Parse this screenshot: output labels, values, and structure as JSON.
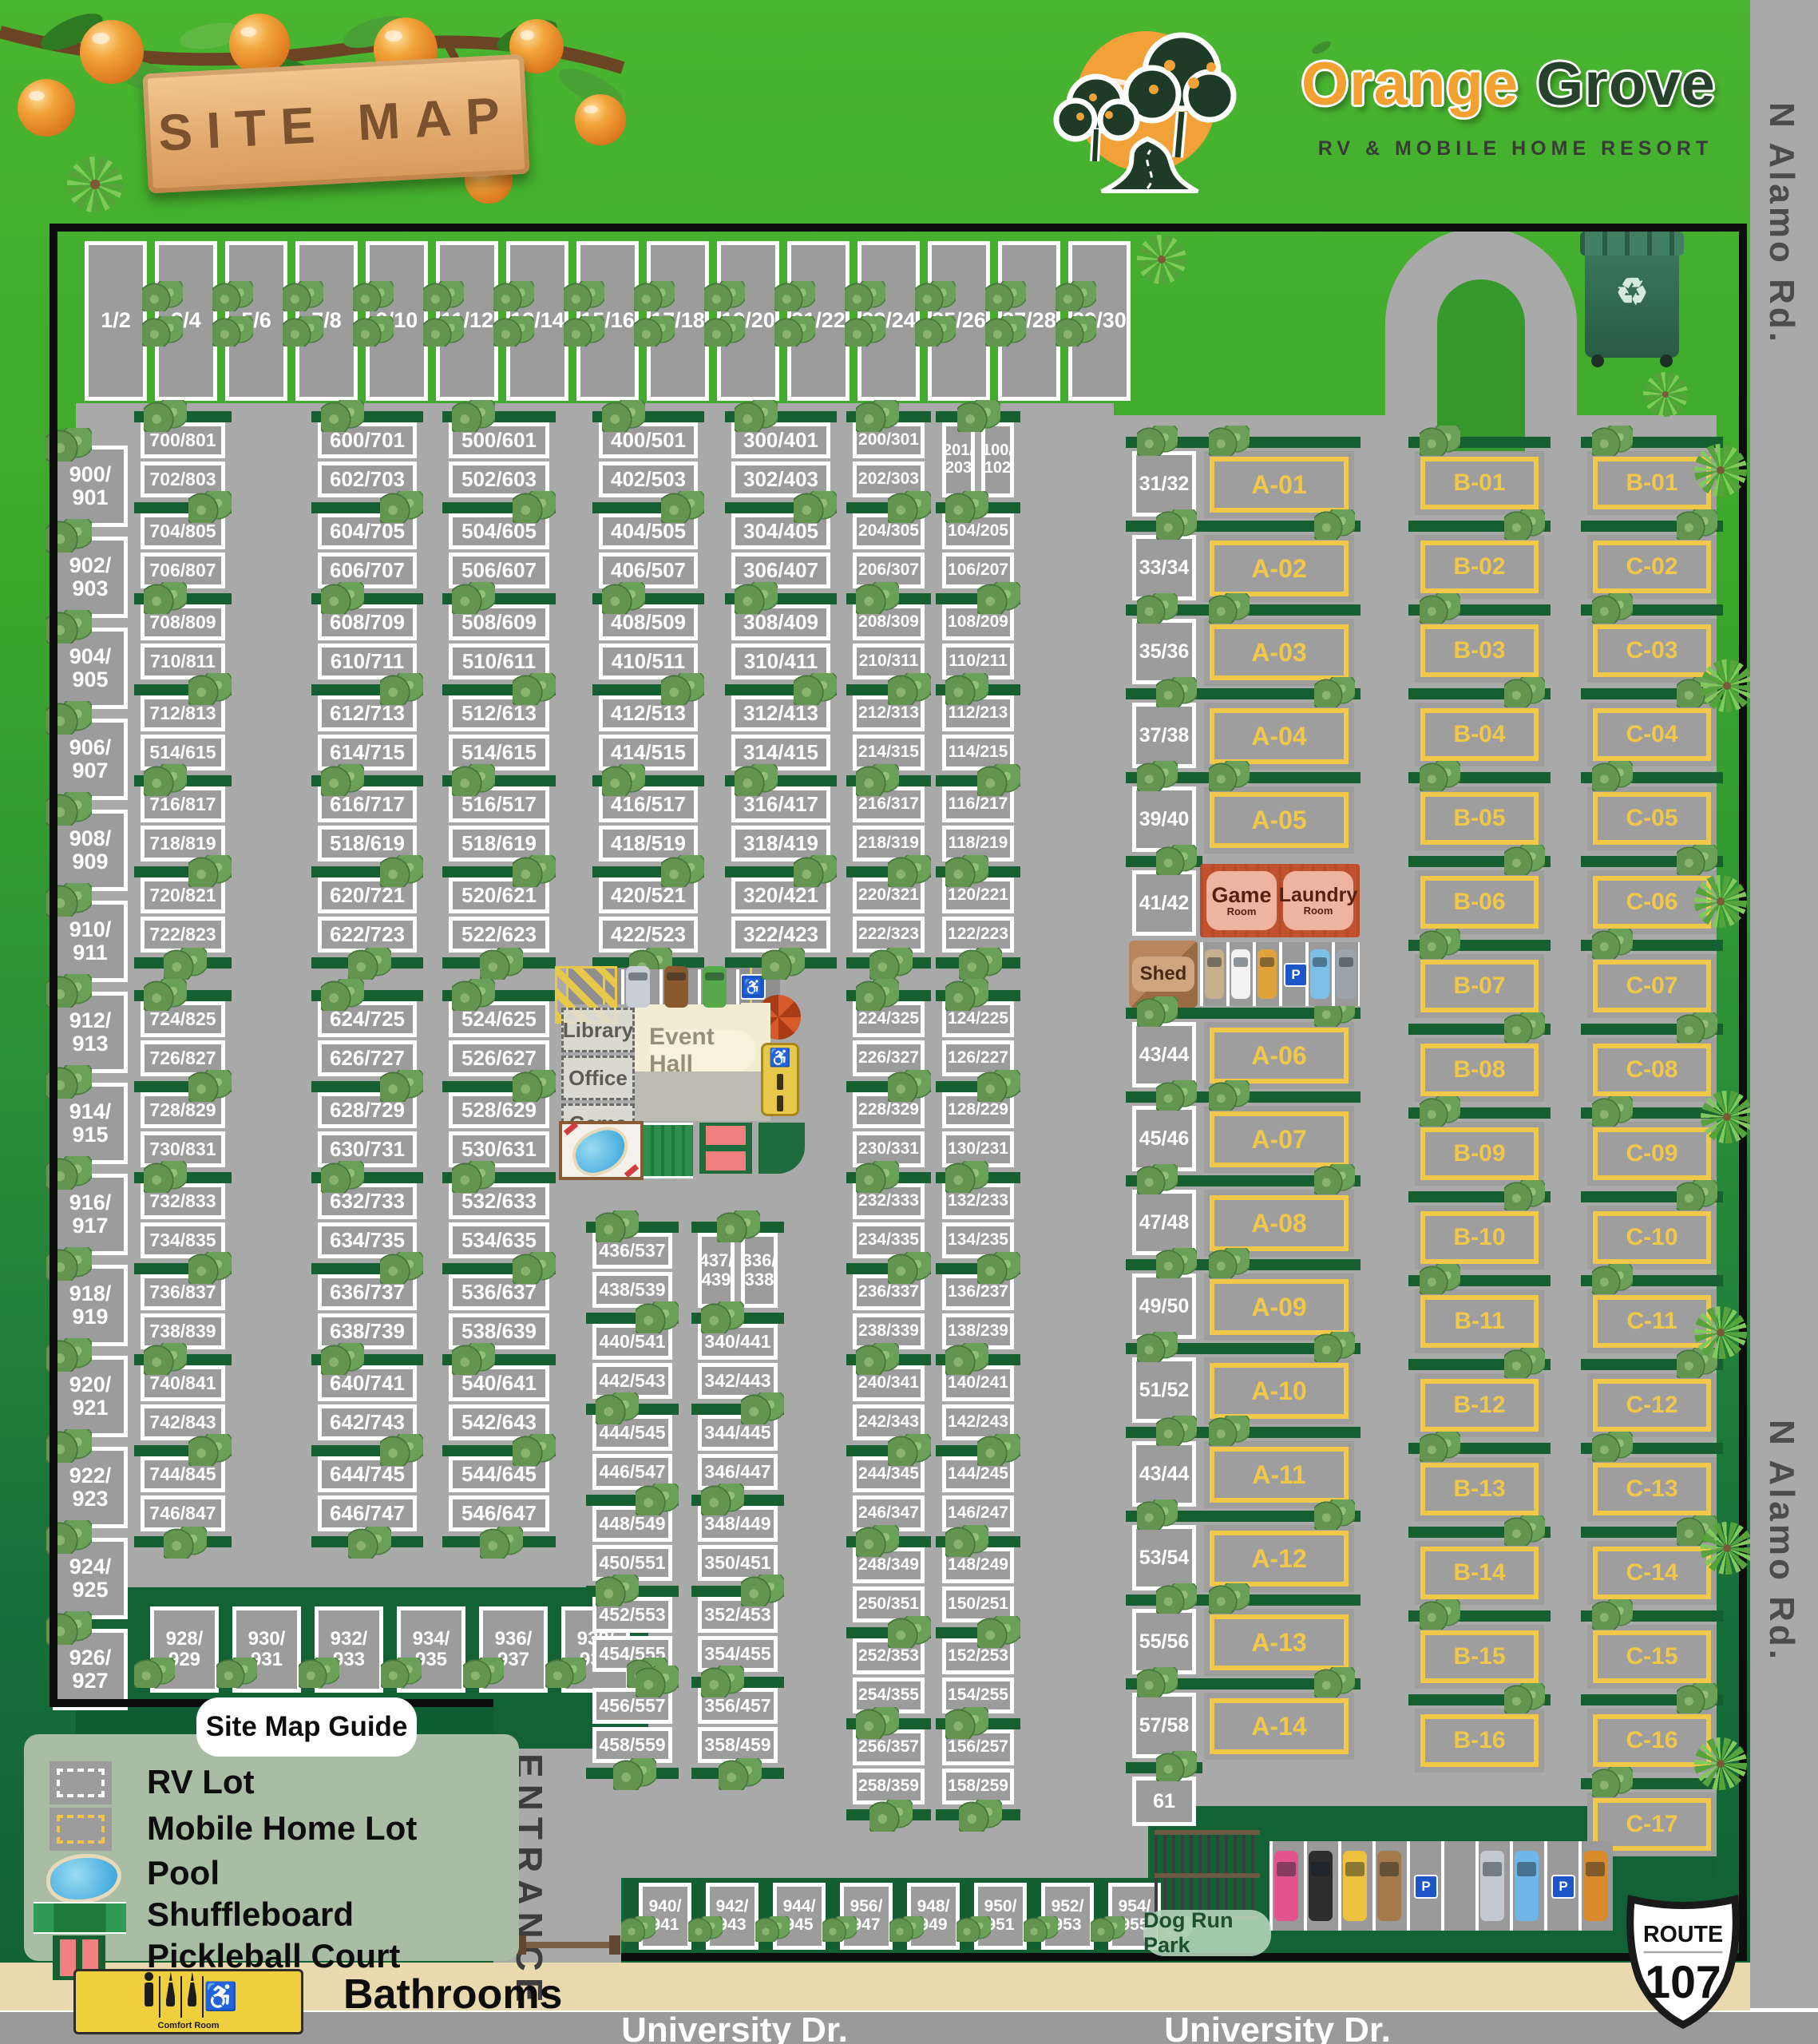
{
  "header": {
    "site_map_sign": "SITE MAP",
    "brand_orange": "Orange",
    "brand_grove": " Grove",
    "brand_sub": "RV & MOBILE HOME RESORT"
  },
  "roads": {
    "n_alamo": "N Alamo Rd.",
    "university": "University Dr.",
    "entrance": "ENTRANCE",
    "route_label": "ROUTE",
    "route_number": "107"
  },
  "legend": {
    "title": "Site Map Guide",
    "items": [
      "RV Lot",
      "Mobile Home Lot",
      "Pool",
      "Shuffleboard",
      "Pickleball Court",
      "Bathrooms"
    ],
    "comfort_room": "Comfort Room"
  },
  "amenities": {
    "library": "Library",
    "office": "Office",
    "game_small": "Game",
    "game_small_sub": "Room",
    "event_hall": "Event Hall",
    "game_room": "Game",
    "game_room_sub": "Room",
    "laundry_room": "Laundry",
    "laundry_room_sub": "Room",
    "shed": "Shed",
    "comfort_room": "Comfort Room",
    "dog_run": "Dog Run Park"
  },
  "icons": {
    "recycle": "♻",
    "wheelchair": "♿",
    "parking": "P"
  },
  "colors": {
    "road": "#a9a9a9",
    "lot_fill": "#9c9c9c",
    "yard_green": "#155f31",
    "mobile_home_accent": "#f2c84a",
    "brand_orange": "#f2a030",
    "brand_green": "#26402b",
    "legend_panel": "#a9bda5",
    "sidewalk_tan": "#ead9ae",
    "building_orange": "#c2512d"
  },
  "parking": {
    "amenity_cars": [
      "#c9ced4",
      "#8a5a2e",
      "#55a948"
    ],
    "mid_cars": [
      "#c7b08e",
      "#f2f2f2",
      "#e0a23a",
      "P",
      "#7cc0e8",
      "#9aa4ad"
    ],
    "bottom_cars": [
      "#e2558c",
      "#2d2d2d",
      "#eec23c",
      "#a57a4a",
      "P",
      "",
      "#c3c9cf",
      "#6fb7e8",
      "P",
      "#d98a2b"
    ]
  },
  "lots": {
    "top_row": [
      "1/2",
      "3/4",
      "5/6",
      "7/8",
      "9/10",
      "11/12",
      "13/14",
      "15/16",
      "17/18",
      "19/20",
      "21/22",
      "23/24",
      "25/26",
      "27/28",
      "29/30"
    ],
    "left_column": [
      "900/901",
      "902/903",
      "904/905",
      "906/907",
      "908/909",
      "910/911",
      "912/913",
      "914/915",
      "916/917",
      "918/919",
      "920/921",
      "922/923",
      "924/925",
      "926/927"
    ],
    "bottom_left_row": [
      "928/929",
      "930/931",
      "932/933",
      "934/935",
      "936/937",
      "938/939"
    ],
    "bottom_row": [
      "940/941",
      "942/943",
      "944/945",
      "956/947",
      "948/949",
      "950/951",
      "952/953",
      "954/955"
    ],
    "c700_upper": [
      "700/801",
      "702/803",
      "704/805",
      "706/807",
      "708/809",
      "710/811",
      "712/813",
      "514/615",
      "716/817",
      "718/819",
      "720/821",
      "722/823"
    ],
    "c700_lower": [
      "724/825",
      "726/827",
      "728/829",
      "730/831",
      "732/833",
      "734/835",
      "736/837",
      "738/839",
      "740/841",
      "742/843",
      "744/845",
      "746/847"
    ],
    "c600_upper": [
      "600/701",
      "602/703",
      "604/705",
      "606/707",
      "608/709",
      "610/711",
      "612/713",
      "614/715",
      "616/717",
      "518/619",
      "620/721",
      "622/723"
    ],
    "c600_lower": [
      "624/725",
      "626/727",
      "628/729",
      "630/731",
      "632/733",
      "634/735",
      "636/737",
      "638/739",
      "640/741",
      "642/743",
      "644/745",
      "646/747"
    ],
    "c500_upper": [
      "500/601",
      "502/603",
      "504/605",
      "506/607",
      "508/609",
      "510/611",
      "512/613",
      "514/615",
      "516/517",
      "518/619",
      "520/621",
      "522/623"
    ],
    "c500_lower": [
      "524/625",
      "526/627",
      "528/629",
      "530/631",
      "532/633",
      "534/635",
      "536/637",
      "538/639",
      "540/641",
      "542/643",
      "544/645",
      "546/647"
    ],
    "c400_upper": [
      "400/501",
      "402/503",
      "404/505",
      "406/507",
      "408/509",
      "410/511",
      "412/513",
      "414/515",
      "416/517",
      "418/519",
      "420/521",
      "422/523"
    ],
    "c400_lower": [
      "436/537",
      "438/539",
      "440/541",
      "442/543",
      "444/545",
      "446/547",
      "448/549",
      "450/551",
      "452/553",
      "454/555",
      "456/557",
      "458/559"
    ],
    "c300_upper": [
      "300/401",
      "302/403",
      "304/405",
      "306/407",
      "308/409",
      "310/411",
      "312/413",
      "314/415",
      "316/417",
      "318/419",
      "320/421",
      "322/423"
    ],
    "c300_lower_pair": [
      "437/439",
      "336/338"
    ],
    "c300_lower": [
      "340/441",
      "342/443",
      "344/445",
      "346/447",
      "348/449",
      "350/451",
      "352/453",
      "354/455",
      "356/457",
      "358/459"
    ],
    "c200_upper": [
      "200/301",
      "202/303",
      "204/305",
      "206/307",
      "208/309",
      "210/311",
      "212/313",
      "214/315",
      "216/317",
      "218/319",
      "220/321",
      "222/323"
    ],
    "c200_lower": [
      "224/325",
      "226/327",
      "228/329",
      "230/331",
      "232/333",
      "234/335",
      "236/337",
      "238/339",
      "240/341",
      "242/343",
      "244/345",
      "246/347",
      "248/349",
      "250/351",
      "252/353",
      "254/355",
      "256/357",
      "258/359"
    ],
    "c100_pair": [
      "201/203",
      "100/102"
    ],
    "c100_upper": [
      "104/205",
      "106/207",
      "108/209",
      "110/211",
      "112/213",
      "114/215",
      "116/217",
      "118/219",
      "120/221",
      "122/223"
    ],
    "c100_lower": [
      "124/225",
      "126/227",
      "128/229",
      "130/231",
      "132/233",
      "134/235",
      "136/237",
      "138/239",
      "140/241",
      "142/243",
      "144/245",
      "146/247",
      "148/249",
      "150/251",
      "152/253",
      "154/255",
      "156/257",
      "158/259"
    ],
    "small_col_upper": [
      "31/32",
      "33/34",
      "35/36",
      "37/38",
      "39/40",
      "41/42"
    ],
    "small_col_lower": [
      "43/44",
      "45/46",
      "47/48",
      "49/50",
      "51/52",
      "43/44",
      "53/54",
      "55/56",
      "57/58",
      "61"
    ],
    "a_col": [
      "A-01",
      "A-02",
      "A-03",
      "A-04",
      "A-05",
      "A-06",
      "A-07",
      "A-08",
      "A-09",
      "A-10",
      "A-11",
      "A-12",
      "A-13",
      "A-14"
    ],
    "b_col": [
      "B-01",
      "B-02",
      "B-03",
      "B-04",
      "B-05",
      "B-06",
      "B-07",
      "B-08",
      "B-09",
      "B-10",
      "B-11",
      "B-12",
      "B-13",
      "B-14",
      "B-15",
      "B-16"
    ],
    "c_col": [
      "B-01",
      "C-02",
      "C-03",
      "C-04",
      "C-05",
      "C-06",
      "C-07",
      "C-08",
      "C-09",
      "C-10",
      "C-11",
      "C-12",
      "C-13",
      "C-14",
      "C-15",
      "C-16",
      "C-17"
    ]
  }
}
